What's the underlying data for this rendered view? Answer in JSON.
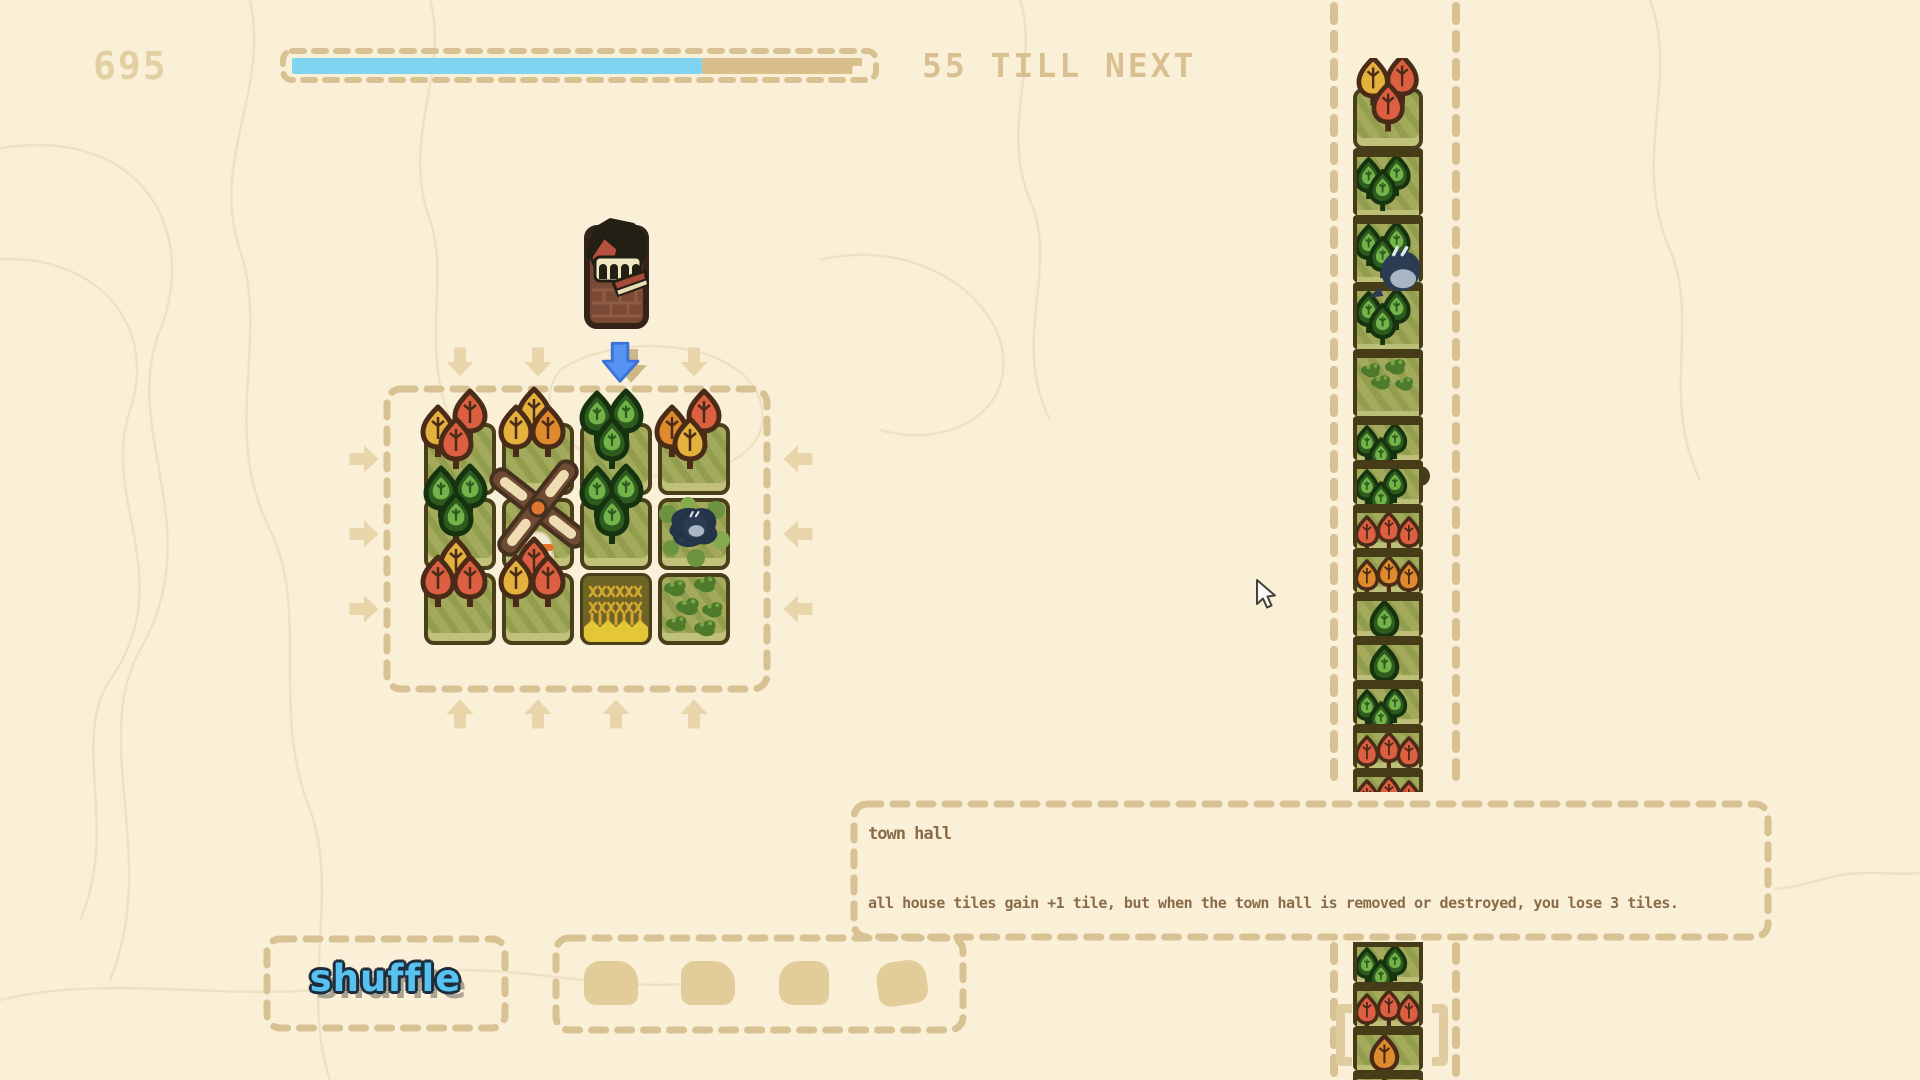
{
  "hud": {
    "score": "695",
    "till_next_label": "55 TILL NEXT",
    "progress_pct": 72
  },
  "preview_tile": {
    "name": "town hall"
  },
  "drop_column_index": 2,
  "board": {
    "cols": 4,
    "rows": 3,
    "tiles": [
      {
        "type": "trees",
        "trees": [
          {
            "p": "TR",
            "c": "red"
          },
          {
            "p": "L",
            "c": "yellow"
          },
          {
            "p": "B",
            "c": "red"
          }
        ]
      },
      {
        "type": "trees",
        "trees": [
          {
            "p": "T",
            "c": "yellow"
          },
          {
            "p": "L",
            "c": "yellow"
          },
          {
            "p": "R",
            "c": "orange"
          }
        ]
      },
      {
        "type": "forest"
      },
      {
        "type": "trees",
        "trees": [
          {
            "p": "TR",
            "c": "red"
          },
          {
            "p": "L",
            "c": "orange"
          },
          {
            "p": "B",
            "c": "yellow"
          }
        ]
      },
      {
        "type": "forest"
      },
      {
        "type": "windmill"
      },
      {
        "type": "forest"
      },
      {
        "type": "pond_bird"
      },
      {
        "type": "trees",
        "trees": [
          {
            "p": "T",
            "c": "yellow"
          },
          {
            "p": "L",
            "c": "red"
          },
          {
            "p": "R",
            "c": "red"
          }
        ]
      },
      {
        "type": "trees",
        "trees": [
          {
            "p": "T",
            "c": "red"
          },
          {
            "p": "L",
            "c": "yellow"
          },
          {
            "p": "R",
            "c": "red"
          }
        ]
      },
      {
        "type": "wheat"
      },
      {
        "type": "bushes"
      }
    ]
  },
  "queue": {
    "top_tile": {
      "type": "trees",
      "trees": [
        {
          "p": "TL",
          "c": "yellow"
        },
        {
          "p": "TR",
          "c": "red"
        },
        {
          "p": "B",
          "c": "red"
        }
      ]
    },
    "upper_units": [
      "forest",
      "forest",
      "forest",
      "bushes",
      "forest",
      "forest",
      "red",
      "orange",
      "forest1",
      "forest1",
      "forest",
      "red",
      "red"
    ],
    "bird_on_unit_index": 2,
    "notch_on_unit_index": 5,
    "lower_units": [
      "forest",
      "red",
      "orange1",
      "orange1"
    ],
    "bracket_on_lower_index": 2
  },
  "tooltip": {
    "title": "town hall",
    "body": "all house tiles gain +1 tile, but when the town hall is removed or destroyed, you lose 3 tiles."
  },
  "shuffle_button": {
    "label": "shuffle"
  },
  "slot_tray": {
    "slots": 4
  },
  "colors": {
    "bg": "#faf0d8",
    "topo": "#ecdfc0",
    "dash": "#d8c192",
    "score_text": "#e3d0a2",
    "hud_text": "#d8c091",
    "bar_fill": "#7fd4f2",
    "bar_rest": "#d9bf8c",
    "tile_border": "#4a3f1b",
    "grass_light": "#a3aa5c",
    "grass_dark": "#929e4e",
    "grass_bevel": "#c0c27c",
    "autumn_outline": "#4a2b18",
    "leaf_red": "#dd5f41",
    "leaf_orange": "#df8a2c",
    "leaf_yellow": "#e3b13c",
    "forest_fill": "#2e5c1f",
    "forest_outline": "#163310",
    "forest_inner": "#74b34a",
    "windmill_wood": "#6f4b34",
    "windmill_wood_edge": "#46301f",
    "windmill_cream": "#eedcb2",
    "windmill_accent": "#e2762e",
    "windmill_white": "#f2ead2",
    "pond": "#253449",
    "bird_body": "#2b3b52",
    "bird_wing": "#a8b6c4",
    "moss": "#6b9340",
    "moss_light": "#86ab4e",
    "wheat_bg": "#6e6425",
    "wheat_gold": "#d6a72e",
    "wheat_band": "#e5c637",
    "brick": "#7a4a36",
    "brick_line": "#8f5c43",
    "roof_dark": "#222014",
    "arch_cream": "#f0e6c2",
    "roof_red": "#b5503c",
    "awning_red": "#a84a38",
    "awning_trim": "#e8dcb0",
    "arrow_tan": "#e8d5a9",
    "arrow_blue": "#5494f0",
    "arrow_blue_edge": "#3a72d8",
    "arrow_shadow": "#cdb787",
    "tooltip_text": "#8a6c49",
    "shuffle_blue": "#57c1ef",
    "shuffle_outline": "#1e2d3c",
    "slot_blob": "#e2cc9a",
    "bracket": "#e0cc9e",
    "notch": "#463c18"
  }
}
